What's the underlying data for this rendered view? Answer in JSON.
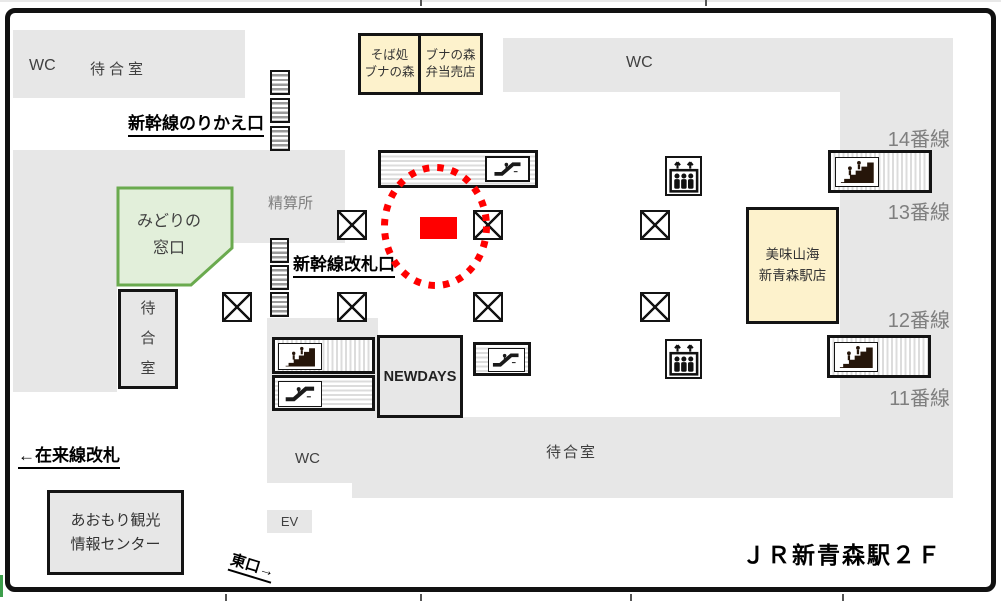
{
  "station_map": {
    "title": "ＪＲ新青森駅２Ｆ",
    "facilities": {
      "wc_top_left": "WC",
      "waiting_room_top_left": "待合室",
      "shinkansen_transfer_gate": "新幹線のりかえ口",
      "wc_top_center": "WC",
      "fare_adjustment_office": "精算所",
      "midori_no_madoguchi": [
        "みどりの",
        "窓口"
      ],
      "shinkansen_ticket_gate": "新幹線改札口",
      "waiting_room_left_vertical": [
        "待",
        "合",
        "室"
      ],
      "conventional_line_gate": "←在来線改札",
      "tourist_info_center": [
        "あおもり観光",
        "情報センター"
      ],
      "elevator_label": "EV",
      "east_exit": "東口→",
      "wc_bottom": "WC",
      "waiting_room_bottom": "待合室",
      "newdays": "NEWDAYS",
      "soba_shop": [
        "そば処",
        "ブナの森"
      ],
      "bento_shop": [
        "ブナの森",
        "弁当売店"
      ],
      "restaurant": [
        "美味山海",
        "新青森駅店"
      ]
    },
    "platforms": [
      "14番線",
      "13番線",
      "12番線",
      "11番線"
    ],
    "marker": {
      "type": "current-location",
      "shape": "red rectangle inside red dotted circle"
    },
    "icons": [
      "stairs-icon",
      "escalator-icon",
      "elevator-icon",
      "pillar-x-icon",
      "ticket-gate-icon"
    ],
    "colors": {
      "area_gray": "#e7e7e7",
      "shop_yellow": "#fdf2cc",
      "green_fill": "#e2efda",
      "green_border": "#6aaa4e",
      "marker_red": "#ff0000",
      "label_gray": "#7f7f7f"
    }
  }
}
